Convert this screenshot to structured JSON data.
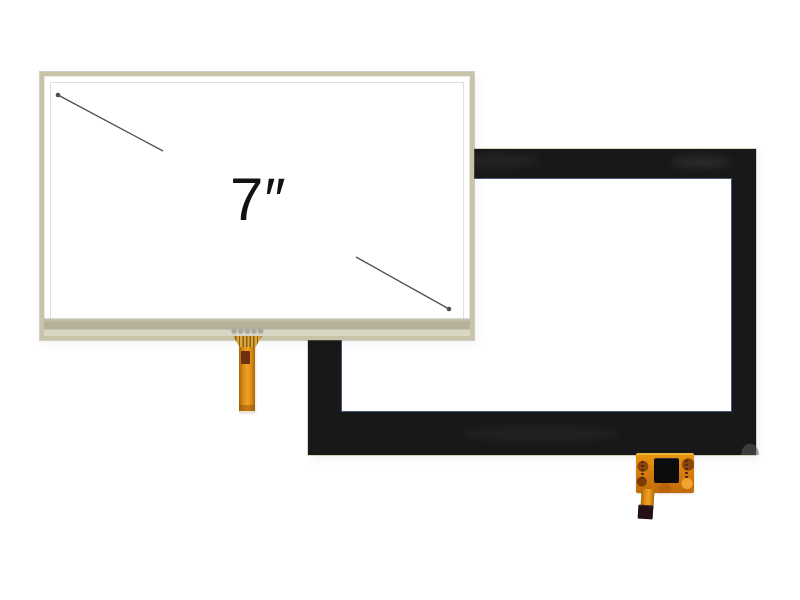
{
  "photo": {
    "background_color": "#ffffff",
    "size_label": "7″",
    "front_panel": {
      "frame_color": "#c8c4a9",
      "bottom_band_color": "#b5b198",
      "bottom_strip_color": "#d9d6c6",
      "surface_color": "#ffffff"
    },
    "rear_panel": {
      "bezel_color": "#181818",
      "inner_edge_color": "#46547e",
      "opening_color": "#ffffff"
    },
    "flex_cable_front": {
      "ribbon_color": "#e08c14",
      "gold_finger_color": "#d9a93e",
      "patch_color": "#6e2f12"
    },
    "flex_cable_rear": {
      "ribbon_color": "#d27a0e",
      "chip_color": "#0c0c0c",
      "connector_tip_color": "#241018"
    },
    "arrows": {
      "color": "#4f4f4f"
    }
  }
}
